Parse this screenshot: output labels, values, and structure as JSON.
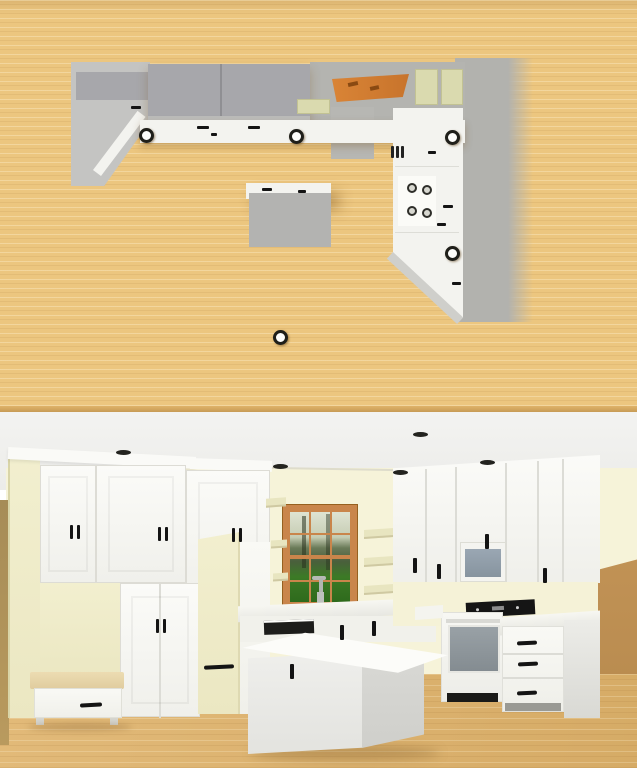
{
  "scene": {
    "type": "kitchen-design-preview",
    "views": [
      {
        "id": "floor-plan",
        "label": "top-down floor plan view"
      },
      {
        "id": "render-3d",
        "label": "3d perspective render view"
      }
    ]
  },
  "palette": {
    "plan_floor": "#ecc67f",
    "plan_cabinet_dark": "#a7a7ab",
    "plan_cabinet_light": "#c4c4c2",
    "plan_wall": "#b2b2ae",
    "plan_counter": "#f3f3ef",
    "plan_window_wood": "#ce7a33",
    "plan_shelf_pale": "#dadaaf",
    "plan_island": "#b3b3b1",
    "render_ceiling": "#f1f1ef",
    "render_wall_cream": "#f6f3d9",
    "render_wall_tan": "#bf9054",
    "render_floor": "#dcb171",
    "cabinet_white": "#f8f8f4",
    "cabinet_cream": "#efecc9",
    "handle_black": "#141414",
    "window_frame": "#c9854b",
    "window_grass": "#3f7b28",
    "microwave_screen": "#93a0ad",
    "oven_window": "#8e969b",
    "appliance_panel": "#161616",
    "bench_cushion": "#e7d4a8"
  },
  "floor_plan": {
    "elements": [
      "north-wall-cabinet-run",
      "west-tall-cabinet-block",
      "window-top-view",
      "open-shelf-blocks",
      "sink-cabinet",
      "dishwasher-mark",
      "range-cooktop-burners",
      "east-counter-run",
      "diagonal-corner-cabinet",
      "kitchen-island",
      "recessed-ceiling-lights"
    ],
    "ceiling_lights": [
      {
        "x": 146,
        "y": 135
      },
      {
        "x": 296,
        "y": 136
      },
      {
        "x": 452,
        "y": 137
      },
      {
        "x": 452,
        "y": 253
      },
      {
        "x": 280,
        "y": 337
      }
    ],
    "cooktop_burners": [
      {
        "x": 412,
        "y": 188
      },
      {
        "x": 427,
        "y": 190
      },
      {
        "x": 412,
        "y": 211
      },
      {
        "x": 427,
        "y": 213
      }
    ],
    "handle_ticks": [
      {
        "x": 197,
        "y": 126,
        "w": 12
      },
      {
        "x": 248,
        "y": 126,
        "w": 12
      },
      {
        "x": 211,
        "y": 133,
        "w": 6
      },
      {
        "x": 262,
        "y": 188,
        "w": 10
      },
      {
        "x": 298,
        "y": 190,
        "w": 8
      },
      {
        "x": 131,
        "y": 106,
        "w": 10
      },
      {
        "x": 428,
        "y": 151,
        "w": 8
      },
      {
        "x": 443,
        "y": 205,
        "w": 10
      },
      {
        "x": 452,
        "y": 282,
        "w": 9
      },
      {
        "x": 437,
        "y": 223,
        "w": 9
      }
    ],
    "dishwasher_mark": {
      "x": 391,
      "y": 146
    }
  },
  "render_3d": {
    "elements": [
      "tall-pantry-wall",
      "mudroom-bench-with-drawer",
      "refrigerator-panel",
      "wood-frame-window",
      "open-shelves",
      "sink-run-with-faucet",
      "dishwasher",
      "kitchen-island",
      "upper-cabinet-run",
      "over-range-microwave",
      "range-oven",
      "drawer-base-cabinets",
      "recessed-ceiling-lights"
    ],
    "ceiling_lights": [
      {
        "x": 123,
        "y": 452
      },
      {
        "x": 280,
        "y": 466
      },
      {
        "x": 400,
        "y": 472
      },
      {
        "x": 420,
        "y": 434
      },
      {
        "x": 487,
        "y": 462
      }
    ],
    "handles": [
      {
        "type": "pair",
        "x": 70,
        "y": 525
      },
      {
        "type": "pair",
        "x": 158,
        "y": 527
      },
      {
        "type": "pair",
        "x": 232,
        "y": 528
      },
      {
        "type": "pair",
        "x": 156,
        "y": 619
      },
      {
        "type": "v",
        "x": 290,
        "y": 664
      },
      {
        "type": "v",
        "x": 340,
        "y": 625
      },
      {
        "type": "v",
        "x": 372,
        "y": 621
      },
      {
        "type": "v",
        "x": 413,
        "y": 558
      },
      {
        "type": "v",
        "x": 437,
        "y": 564
      },
      {
        "type": "v",
        "x": 485,
        "y": 534
      },
      {
        "type": "v",
        "x": 543,
        "y": 568
      },
      {
        "type": "h",
        "x": 80,
        "y": 703,
        "w": 22
      },
      {
        "type": "h",
        "x": 204,
        "y": 665,
        "w": 30
      },
      {
        "type": "h",
        "x": 517,
        "y": 641,
        "w": 20
      },
      {
        "type": "h",
        "x": 518,
        "y": 662,
        "w": 20
      },
      {
        "type": "h",
        "x": 517,
        "y": 691,
        "w": 20
      }
    ],
    "window": {
      "mullion_cols": 3,
      "mullion_rows": 4
    },
    "open_shelves_count": 3
  }
}
